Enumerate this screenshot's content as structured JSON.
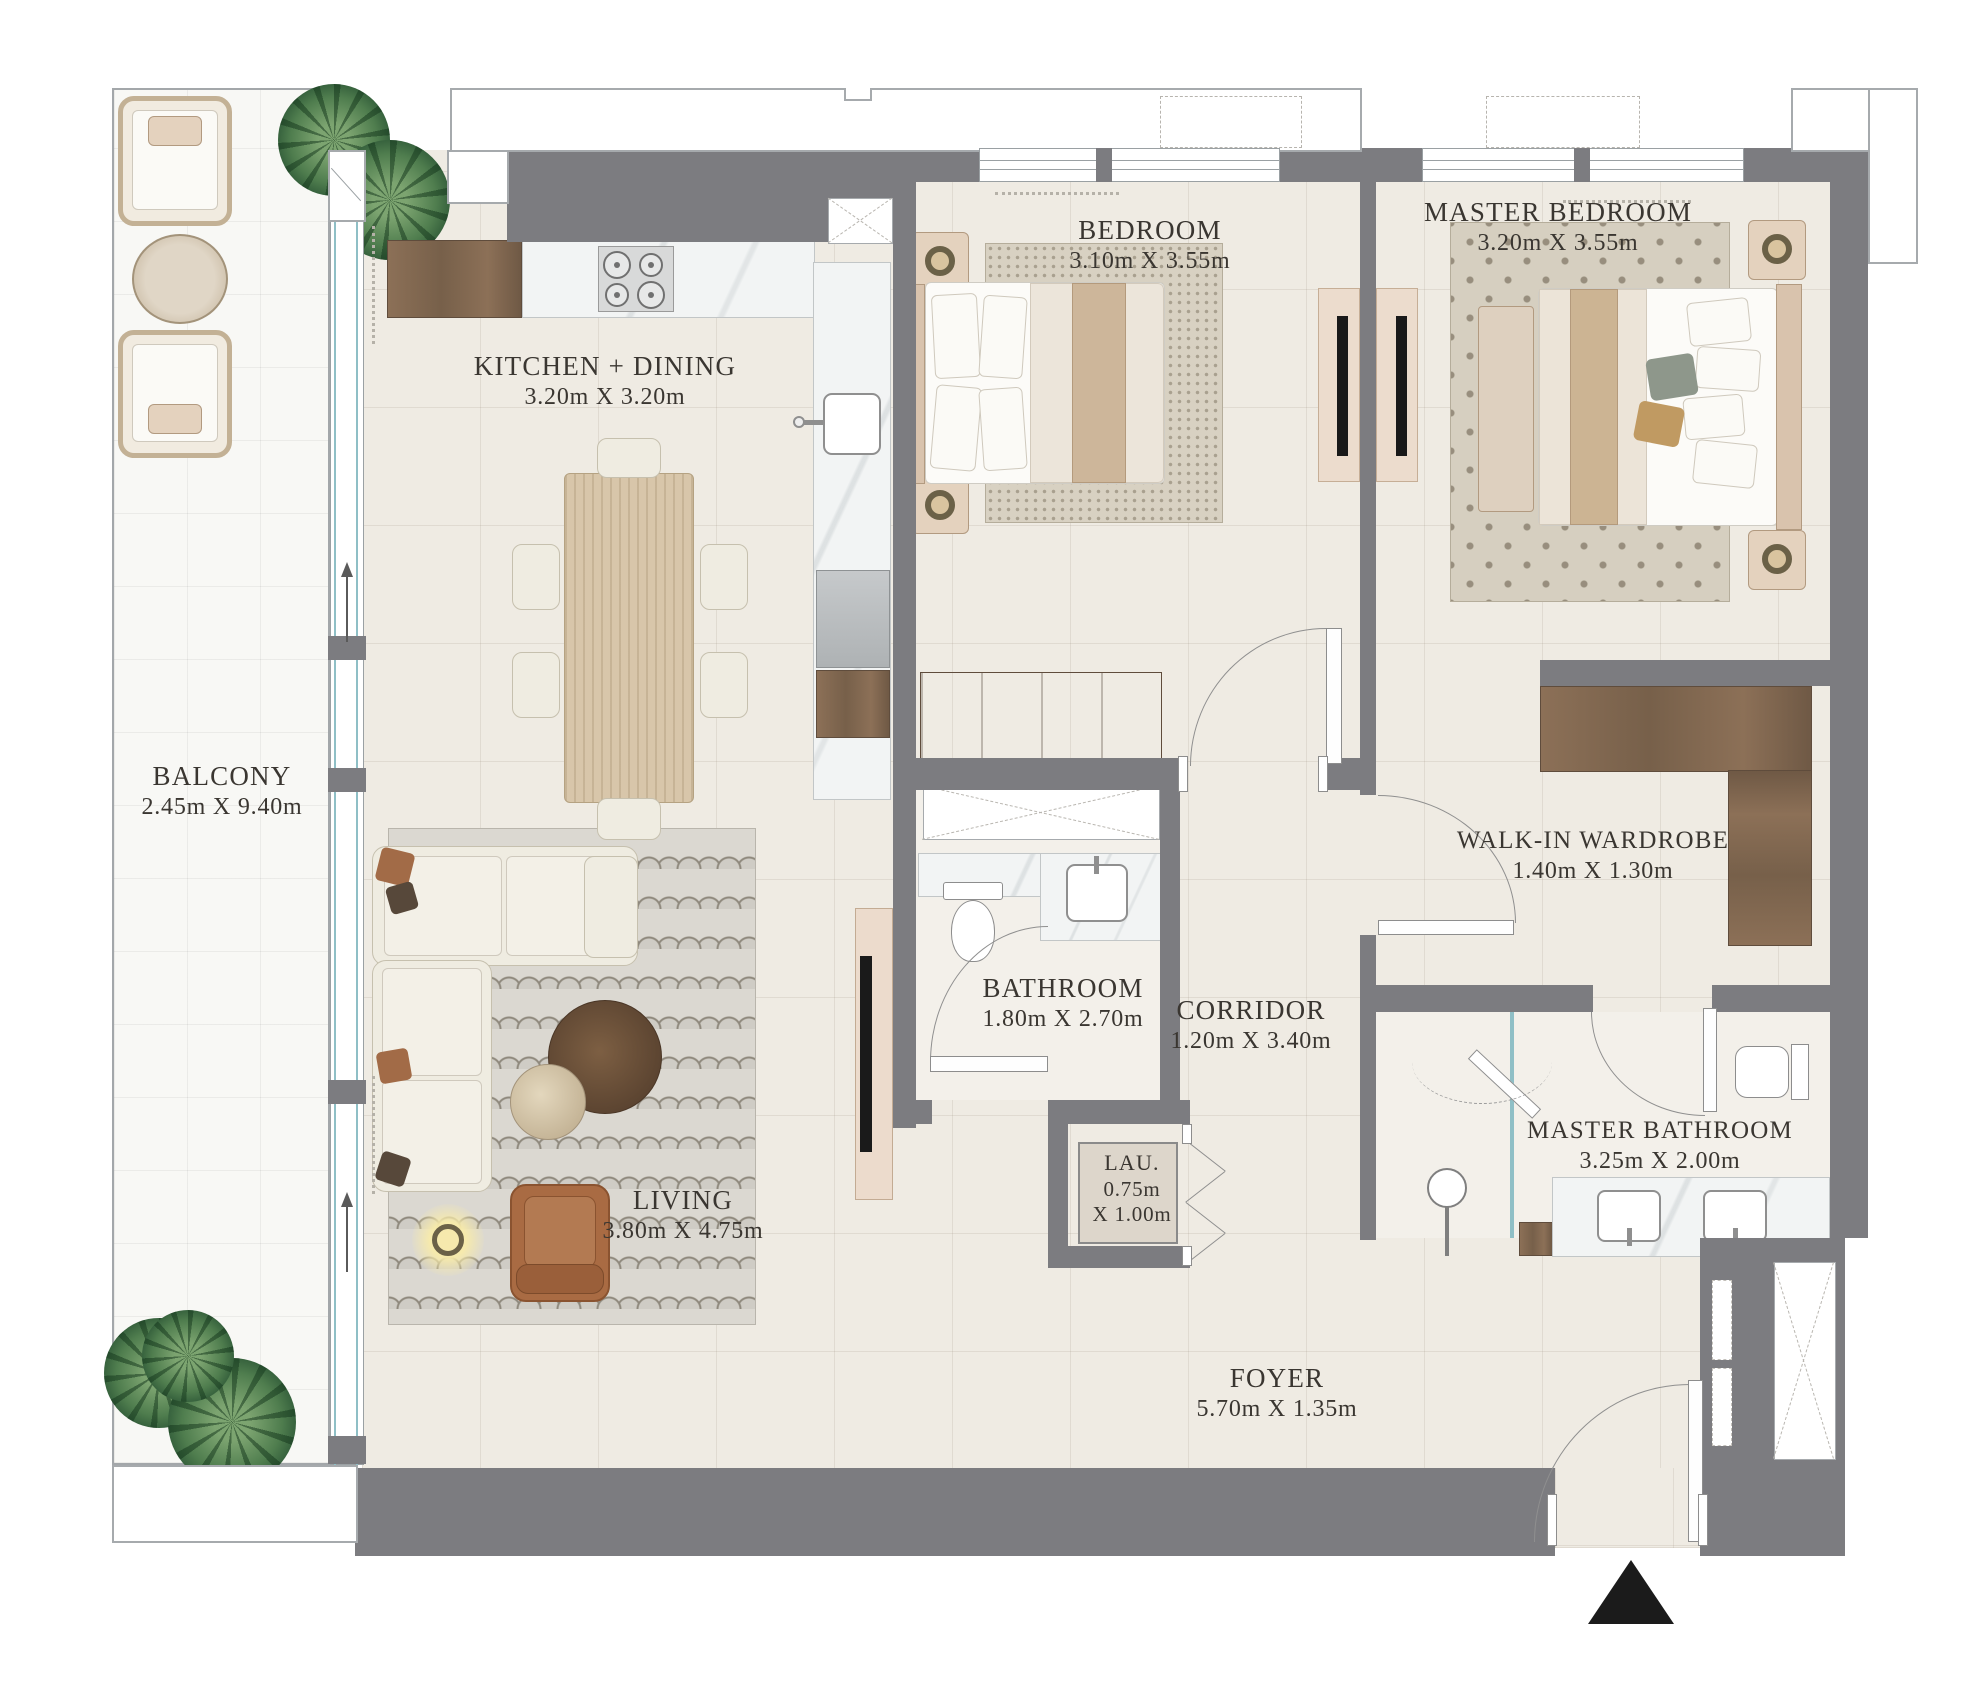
{
  "plan": {
    "title": "2 Bedroom Apartment Floor Plan",
    "rooms": {
      "balcony": {
        "name": "BALCONY",
        "dims": "2.45m X 9.40m"
      },
      "kitchen_dining": {
        "name": "KITCHEN + DINING",
        "dims": "3.20m X 3.20m"
      },
      "bedroom": {
        "name": "BEDROOM",
        "dims": "3.10m X 3.55m"
      },
      "master_bedroom": {
        "name": "MASTER BEDROOM",
        "dims": "3.20m X 3.55m"
      },
      "walk_in_wardrobe": {
        "name": "WALK-IN WARDROBE",
        "dims": "1.40m X 1.30m"
      },
      "bathroom": {
        "name": "BATHROOM",
        "dims": "1.80m X 2.70m"
      },
      "corridor": {
        "name": "CORRIDOR",
        "dims": "1.20m X 3.40m"
      },
      "laundry": {
        "name": "LAU.",
        "dim_line1": "0.75m",
        "dim_line2": "X 1.00m"
      },
      "master_bathroom": {
        "name": "MASTER BATHROOM",
        "dims": "3.25m X 2.00m"
      },
      "living": {
        "name": "LIVING",
        "dims": "3.80m X 4.75m"
      },
      "foyer": {
        "name": "FOYER",
        "dims": "5.70m X 1.35m"
      }
    },
    "colors": {
      "wall": "#7c7c80",
      "floor": "#efebe3",
      "balcony_floor": "#f8f8f5",
      "wood": "#8c7057",
      "glass": "#8fbfc6",
      "entrance_marker": "#1b1b1b"
    }
  }
}
